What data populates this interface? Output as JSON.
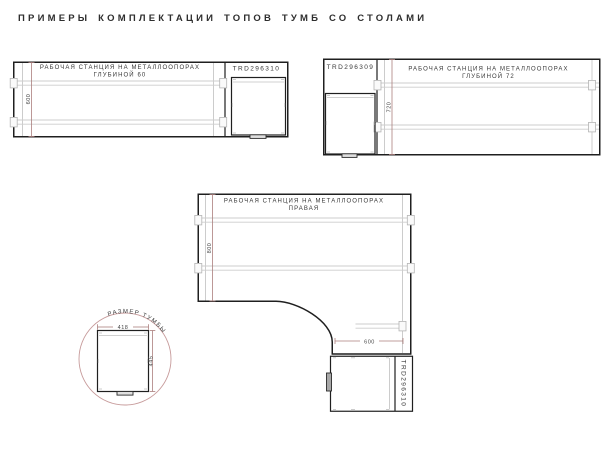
{
  "page": {
    "title": "ПРИМЕРЫ КОМПЛЕКТАЦИИ ТОПОВ ТУМБ СО СТОЛАМИ"
  },
  "colors": {
    "outline_black": "#1f1f1f",
    "detail_gray": "#cdcdcd",
    "dimension_red": "#ab7f7d",
    "detail_circle_red": "#c79b9b",
    "text_dark": "#383838"
  },
  "diagrams": {
    "desk60": {
      "title_line1": "РАБОЧАЯ СТАНЦИЯ НА МЕТАЛЛООПОРАХ",
      "title_line2": "ГЛУБИНОЙ 60",
      "code": "TRD296310",
      "depth_dim": "600"
    },
    "desk72": {
      "code": "TRD296309",
      "title_line1": "РАБОЧАЯ СТАНЦИЯ НА МЕТАЛЛООПОРАХ",
      "title_line2": "ГЛУБИНОЙ 72",
      "depth_dim": "720"
    },
    "desk_corner": {
      "title_line1": "РАБОЧАЯ СТАНЦИЯ НА МЕТАЛЛООПОРАХ",
      "title_line2": "ПРАВАЯ",
      "depth_dim": "800",
      "width_dim": "600",
      "code": "TRD296310"
    },
    "cabinet_size": {
      "label": "РАЗМЕР ТУМБЫ",
      "width_dim": "418",
      "height_dim": "445"
    }
  }
}
